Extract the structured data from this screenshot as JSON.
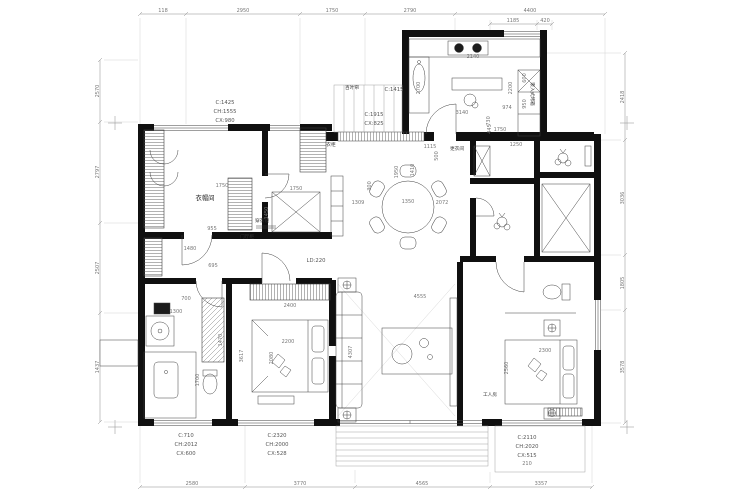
{
  "drawing": {
    "type": "apartment floor plan",
    "wall_color": "#101010",
    "line_color": "#3f3f3f",
    "dim_color": "#8c8c8c"
  },
  "dims": {
    "top": [
      "118",
      "2950",
      "1750",
      "2790",
      "4400"
    ],
    "kitchen_top": [
      "1185",
      "420"
    ],
    "bottom": [
      "2580",
      "3770",
      "4565",
      "3357"
    ],
    "left": [
      "2570",
      "2797",
      "2507",
      "1437"
    ],
    "right": [
      "2418",
      "3036",
      "1805",
      "3578"
    ]
  },
  "windows": {
    "w1": {
      "l1": "C:1425",
      "l2": "CH:1555",
      "l3": "CX:980"
    },
    "w2": {
      "l1": "C:1915",
      "l2": "CX:825"
    },
    "w3": {
      "l1": "C:1415"
    },
    "w4": {
      "l1": "C:710",
      "l2": "CH:2012",
      "l3": "CX:600"
    },
    "w5": {
      "l1": "C:2320",
      "l2": "CH:2000",
      "l3": "CX:528"
    },
    "w6": {
      "l1": "C:2110",
      "l2": "CH:2020",
      "l3": "CX:515"
    }
  },
  "labels": {
    "cloakroom": "衣帽间",
    "wardrobe": "衣柜",
    "dressing_mirror": "穿衣镜",
    "hall_cabinet": "门厅柜",
    "ld_note": "LD:220",
    "louver": "百叶帘",
    "dressing_room": "更衣间",
    "maid_room": "工人房",
    "built_in_oven": "嵌入式烤箱"
  },
  "interior_dims": [
    "2140",
    "3140",
    "730",
    "2700",
    "2200",
    "600",
    "950",
    "974",
    "1750",
    "445",
    "1309",
    "1350",
    "2072",
    "1950",
    "300",
    "1750",
    "955",
    "1450",
    "1750",
    "1250",
    "2400",
    "2200",
    "2080",
    "3617",
    "4555",
    "4307",
    "2300",
    "2560",
    "1300",
    "1700",
    "1470",
    "700",
    "1115",
    "210",
    "500",
    "1410",
    "1480",
    "695"
  ]
}
